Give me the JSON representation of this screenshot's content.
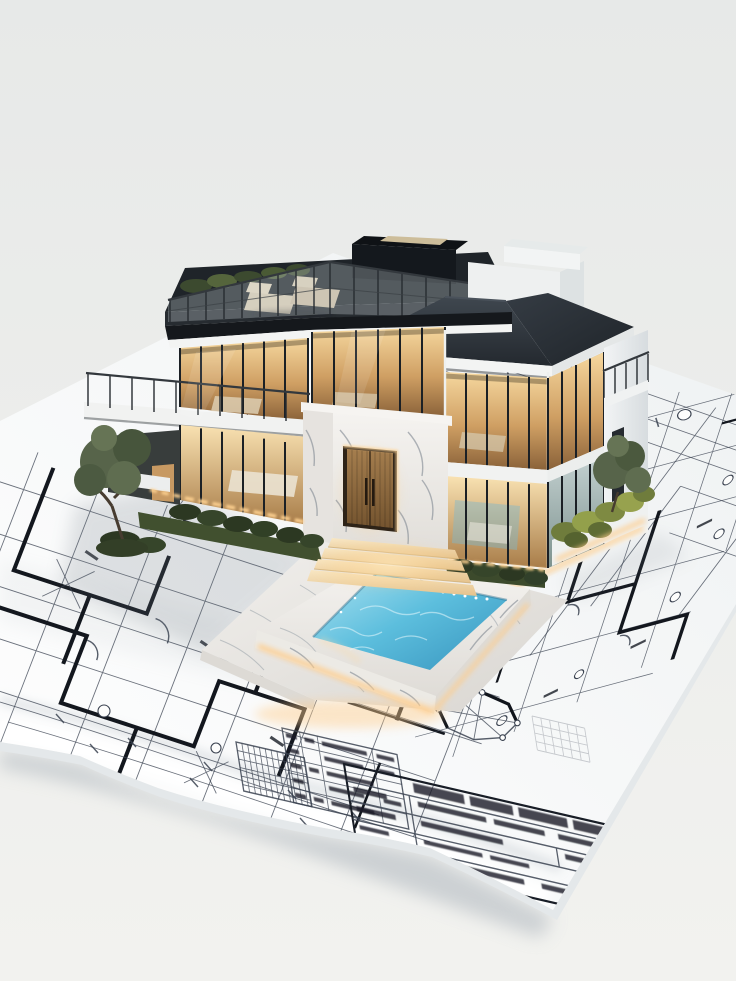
{
  "meta": {
    "domain": "natural-image",
    "description": "Photorealistic architectural scale model of a modern two-storey glass villa with rooftop terrace and illuminated swimming pool, standing on a large unrolled architectural blueprint sheet with a curled lower edge, on a plain pale-grey studio surface.",
    "canvas": {
      "width": 736,
      "height": 981
    }
  },
  "palette": {
    "bg_top": "#e7e9e8",
    "bg_bottom": "#f2f2ef",
    "paper_light": "#ffffff",
    "paper_shade": "#eef1f2",
    "paper_under": "#e4e8ea",
    "line": "#3a4250",
    "wall": "#13171e",
    "ink_bar": "#161b24",
    "roof_light": "#3f474f",
    "roof_dark": "#24292f",
    "deck": "#272c31",
    "fascia": "#f3f4f3",
    "white_wall": "#eef0f1",
    "glass_warm_top": "#f6d89f",
    "glass_warm_mid": "#cf9f63",
    "glass_warm_deep": "#8a6239",
    "glass_cool_top": "#c3d0d0",
    "glass_cool_deep": "#7d928e",
    "mullion": "#1b2025",
    "marble_light": "#f5f3f0",
    "marble_dark": "#dfdcd7",
    "wood_light": "#a57e4e",
    "wood_dark": "#74542f",
    "glow_core": "#ffe9bc",
    "glow_warm": "#ffc878",
    "water_light": "#ace2f1",
    "water_mid": "#5cbedd",
    "water_deep": "#3a97c0",
    "grass": "#41502f",
    "hedge": "#2c3822",
    "bush_bright": "#93a04b",
    "tree": "#57644a",
    "trunk": "#473c30",
    "chair": "#d2c5ac",
    "shadow": "#6c7680"
  },
  "scene": {
    "background": {
      "surface": "seamless pale grey studio backdrop, soft daylight"
    },
    "blueprint": {
      "paper": "white floor-plan sheet laid diagonally, lower edge curling up over a second sheet",
      "linework": [
        "thick black plan walls in stepped runs",
        "thin partition and grid lines in two receding directions",
        "dimension strings with oblique tick marks",
        "circular grid bubbles",
        "door swing arcs and cross braces",
        "dense hatched grid detail",
        "octagonal detail drawing with bold edges",
        "faint graph grid patch"
      ],
      "title_block": {
        "position": "bottom right of sheet",
        "heading": "bold lettering, out of focus / illegible",
        "rows": 5
      },
      "revision_table": {
        "position": "left of title block",
        "rows": 5,
        "note": "small illegible entries"
      }
    },
    "house": {
      "storeys": 2,
      "style": "modern luxury villa model",
      "features": [
        "rooftop terrace with glass balustrade, planting and two beige sun loungers",
        "dark flat roof slab and skylit stair bulkhead at rear",
        "white penthouse volumes at rear right",
        "charcoal hip roof over right wing with white fascia",
        "floor-to-ceiling glazing with black mullions and warmly lit interiors",
        "white marble entrance portal with twin timber doors and dark pull handles",
        "wide illuminated entry steps",
        "cantilevered balcony with railing on left wing",
        "recessed balcony beside white pier on right gable",
        "narrow dark window slot in right pier",
        "LED cove lighting along plinth, hedges and planters",
        "two small model trees and low shrubs"
      ]
    },
    "pool": {
      "shape": "rectangular",
      "surround": "white marble coping on a marble terrace slab",
      "water": "turquoise with pale ripple reflections",
      "lighting": "warm LED strip around the base and a row of white spot lights along the inner edge"
    },
    "lighting": "warm interior and landscape LED glow contrasting with cool neutral daylight"
  }
}
